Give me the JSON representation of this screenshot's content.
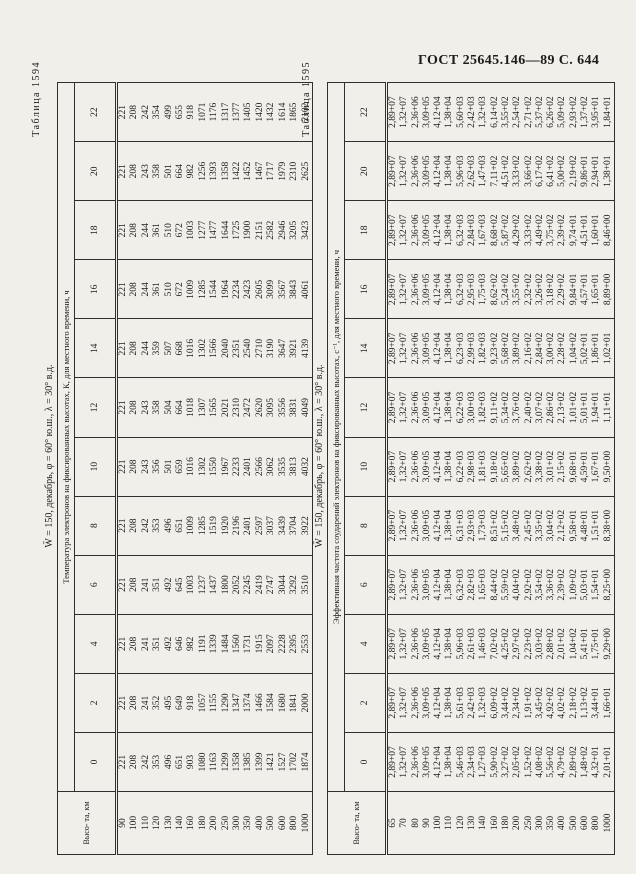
{
  "page_header": "ГОСТ 25645.146—89  С. 644",
  "tables": [
    {
      "label": "Таблица 1594",
      "title": "W̄ = 150, декабрь, φ = 60° ю.ш., λ = 30° в.д.",
      "span_header": "Температура электронов на фиксированных высотах, К, для местного времени, ч",
      "alt_header": "Высо-\nта, км",
      "time_labels": [
        "0",
        "2",
        "4",
        "6",
        "8",
        "10",
        "12",
        "14",
        "16",
        "18",
        "20",
        "22"
      ],
      "altitudes": [
        "90",
        "100",
        "110",
        "120",
        "130",
        "140",
        "160",
        "180",
        "200",
        "250",
        "300",
        "350",
        "400",
        "500",
        "600",
        "800",
        "1000"
      ],
      "rows": [
        [
          "221",
          "221",
          "221",
          "221",
          "221",
          "221",
          "221",
          "221",
          "221",
          "221",
          "221",
          "221"
        ],
        [
          "208",
          "208",
          "208",
          "208",
          "208",
          "208",
          "208",
          "208",
          "208",
          "208",
          "208",
          "208"
        ],
        [
          "242",
          "241",
          "241",
          "241",
          "242",
          "243",
          "243",
          "244",
          "244",
          "244",
          "243",
          "242"
        ],
        [
          "353",
          "352",
          "351",
          "351",
          "353",
          "356",
          "358",
          "359",
          "361",
          "361",
          "358",
          "354"
        ],
        [
          "496",
          "495",
          "492",
          "492",
          "496",
          "501",
          "504",
          "507",
          "510",
          "510",
          "501",
          "499"
        ],
        [
          "651",
          "649",
          "646",
          "645",
          "651",
          "659",
          "664",
          "668",
          "672",
          "672",
          "664",
          "655"
        ],
        [
          "903",
          "918",
          "982",
          "1003",
          "1009",
          "1016",
          "1018",
          "1016",
          "1009",
          "1003",
          "982",
          "918"
        ],
        [
          "1080",
          "1057",
          "1191",
          "1237",
          "1285",
          "1302",
          "1307",
          "1302",
          "1285",
          "1277",
          "1256",
          "1071"
        ],
        [
          "1163",
          "1155",
          "1339",
          "1437",
          "1519",
          "1550",
          "1565",
          "1566",
          "1544",
          "1477",
          "1393",
          "1176"
        ],
        [
          "1299",
          "1290",
          "1484",
          "1800",
          "1920",
          "1967",
          "2021",
          "2040",
          "1964",
          "1644",
          "1358",
          "1317"
        ],
        [
          "1358",
          "1347",
          "1560",
          "2052",
          "2196",
          "2233",
          "2310",
          "2351",
          "2234",
          "1725",
          "1422",
          "1377"
        ],
        [
          "1385",
          "1374",
          "1731",
          "2245",
          "2401",
          "2401",
          "2472",
          "2540",
          "2423",
          "1900",
          "1452",
          "1405"
        ],
        [
          "1399",
          "1466",
          "1915",
          "2419",
          "2597",
          "2566",
          "2620",
          "2710",
          "2605",
          "2151",
          "1467",
          "1420"
        ],
        [
          "1421",
          "1584",
          "2097",
          "2747",
          "3037",
          "3062",
          "3095",
          "3190",
          "3099",
          "2582",
          "1717",
          "1432"
        ],
        [
          "1527",
          "1680",
          "2228",
          "3044",
          "3439",
          "3535",
          "3556",
          "3647",
          "3567",
          "2946",
          "1979",
          "1614"
        ],
        [
          "1702",
          "1841",
          "2395",
          "3292",
          "3704",
          "3813",
          "3831",
          "3921",
          "3843",
          "3205",
          "2310",
          "1865"
        ],
        [
          "1874",
          "2000",
          "2553",
          "3510",
          "3922",
          "4032",
          "4049",
          "4139",
          "4061",
          "3423",
          "2625",
          "2102"
        ]
      ]
    },
    {
      "label": "Таблица 1595",
      "title": "W̄ = 150, декабрь, φ = 60° ю.ш., λ = 30° в.д.",
      "span_header": "Эффективная частота соударений электронов на фиксированных высотах, с⁻¹, для местного времени, ч",
      "alt_header": "Высо-\nта, км",
      "time_labels": [
        "0",
        "2",
        "4",
        "6",
        "8",
        "10",
        "12",
        "14",
        "16",
        "18",
        "20",
        "22"
      ],
      "altitudes": [
        "65",
        "70",
        "80",
        "90",
        "100",
        "110",
        "120",
        "130",
        "140",
        "160",
        "180",
        "200",
        "250",
        "300",
        "350",
        "400",
        "500",
        "600",
        "800",
        "1000"
      ],
      "rows": [
        [
          "2,89+07",
          "2,89+07",
          "2,89+07",
          "2,89+07",
          "2,89+07",
          "2,89+07",
          "2,89+07",
          "2,89+07",
          "2,89+07",
          "2,89+07",
          "2,89+07",
          "2,89+07"
        ],
        [
          "1,32+07",
          "1,32+07",
          "1,32+07",
          "1,32+07",
          "1,32+07",
          "1,32+07",
          "1,32+07",
          "1,32+07",
          "1,32+07",
          "1,32+07",
          "1,32+07",
          "1,32+07"
        ],
        [
          "2,36+06",
          "2,36+06",
          "2,36+06",
          "2,36+06",
          "2,36+06",
          "2,36+06",
          "2,36+06",
          "2,36+06",
          "2,36+06",
          "2,36+06",
          "2,36+06",
          "2,36+06"
        ],
        [
          "3,09+05",
          "3,09+05",
          "3,09+05",
          "3,09+05",
          "3,09+05",
          "3,09+05",
          "3,09+05",
          "3,09+05",
          "3,09+05",
          "3,09+05",
          "3,09+05",
          "3,09+05"
        ],
        [
          "4,12+04",
          "4,12+04",
          "4,12+04",
          "4,12+04",
          "4,12+04",
          "4,12+04",
          "4,12+04",
          "4,12+04",
          "4,12+04",
          "4,12+04",
          "4,12+04",
          "4,12+04"
        ],
        [
          "1,38+04",
          "1,38+04",
          "1,38+04",
          "1,38+04",
          "1,38+04",
          "1,38+04",
          "1,38+04",
          "1,38+04",
          "1,38+04",
          "1,38+04",
          "1,38+04",
          "1,38+04"
        ],
        [
          "5,46+03",
          "5,61+03",
          "5,96+03",
          "6,32+03",
          "6,31+03",
          "6,22+03",
          "6,22+03",
          "6,23+03",
          "6,32+03",
          "6,32+03",
          "5,96+03",
          "5,60+03"
        ],
        [
          "2,34+03",
          "2,42+03",
          "2,61+03",
          "2,82+03",
          "2,93+03",
          "2,98+03",
          "3,00+03",
          "2,99+03",
          "2,95+03",
          "2,84+03",
          "2,62+03",
          "2,42+03"
        ],
        [
          "1,27+03",
          "1,32+03",
          "1,46+03",
          "1,65+03",
          "1,73+03",
          "1,81+03",
          "1,82+03",
          "1,82+03",
          "1,75+03",
          "1,67+03",
          "1,47+03",
          "1,32+03"
        ],
        [
          "5,90+02",
          "6,09+02",
          "7,02+02",
          "8,44+02",
          "8,51+02",
          "9,18+02",
          "9,11+02",
          "9,23+02",
          "8,62+02",
          "8,68+02",
          "7,11+02",
          "6,14+02"
        ],
        [
          "3,27+02",
          "3,44+02",
          "4,25+02",
          "5,59+02",
          "5,15+02",
          "5,65+02",
          "5,34+02",
          "5,68+02",
          "5,24+02",
          "5,87+02",
          "4,51+02",
          "3,55+02"
        ],
        [
          "2,05+02",
          "2,34+02",
          "2,97+02",
          "4,04+02",
          "3,48+02",
          "3,89+02",
          "3,76+02",
          "3,89+02",
          "3,55+02",
          "4,29+02",
          "3,33+02",
          "2,54+02"
        ],
        [
          "1,52+02",
          "1,91+02",
          "2,23+02",
          "2,92+02",
          "2,45+02",
          "2,62+02",
          "2,40+02",
          "2,16+02",
          "2,32+02",
          "3,33+02",
          "3,66+02",
          "2,71+02"
        ],
        [
          "4,08+02",
          "3,45+02",
          "3,03+02",
          "3,54+02",
          "3,35+02",
          "3,38+02",
          "3,07+02",
          "2,84+02",
          "3,26+02",
          "4,49+02",
          "6,17+02",
          "5,37+02"
        ],
        [
          "5,56+02",
          "4,92+02",
          "2,88+02",
          "3,36+02",
          "3,04+02",
          "3,01+02",
          "2,86+02",
          "3,00+02",
          "3,18+02",
          "3,75+02",
          "6,41+02",
          "6,26+02"
        ],
        [
          "4,79+02",
          "4,02+02",
          "2,01+02",
          "2,39+02",
          "2,12+02",
          "2,15+02",
          "2,13+02",
          "2,28+02",
          "2,29+02",
          "2,39+02",
          "5,00+02",
          "5,09+02"
        ],
        [
          "2,89+02",
          "2,18+02",
          "1,04+02",
          "1,09+02",
          "9,58+01",
          "9,68+01",
          "1,01+02",
          "1,04+02",
          "9,84+01",
          "9,74+01",
          "2,19+02",
          "2,93+02"
        ],
        [
          "1,48+02",
          "1,13+02",
          "5,41+01",
          "5,03+01",
          "4,48+01",
          "4,59+01",
          "5,01+01",
          "5,02+01",
          "4,57+01",
          "4,51+01",
          "9,86+01",
          "1,37+02"
        ],
        [
          "4,32+01",
          "3,44+01",
          "1,75+01",
          "1,54+01",
          "1,51+01",
          "1,67+01",
          "1,94+01",
          "1,86+01",
          "1,65+01",
          "1,60+01",
          "2,94+01",
          "3,95+01"
        ],
        [
          "2,01+01",
          "1,66+01",
          "9,29+00",
          "8,25+00",
          "8,38+00",
          "9,50+00",
          "1,11+01",
          "1,02+01",
          "8,89+00",
          "8,46+00",
          "1,38+01",
          "1,84+01"
        ]
      ]
    }
  ]
}
